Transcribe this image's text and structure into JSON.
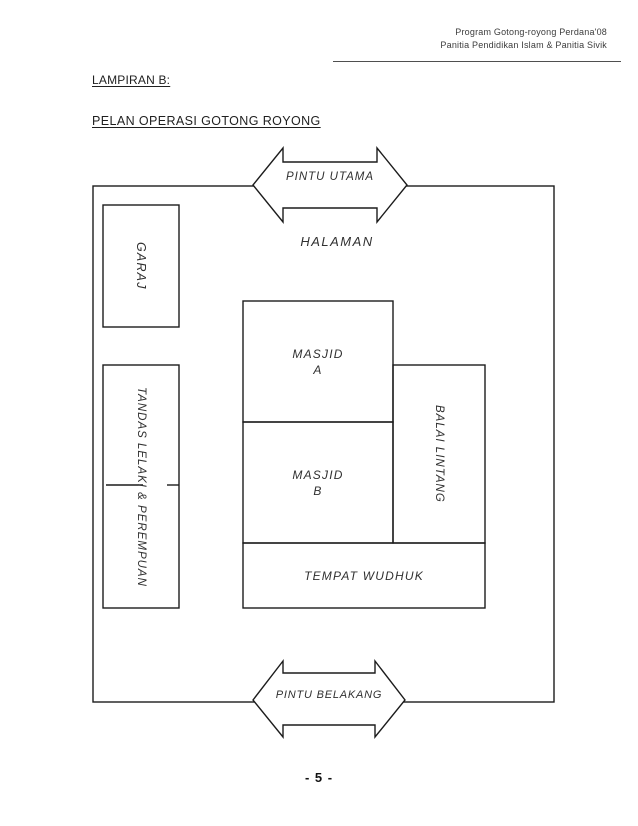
{
  "header": {
    "line1": "Program Gotong-royong Perdana'08",
    "line2": "Panitia Pendidikan Islam & Panitia Sivik"
  },
  "titles": {
    "lampiran": "LAMPIRAN B:",
    "main": "PELAN OPERASI GOTONG ROYONG"
  },
  "diagram": {
    "gates": {
      "top": "PINTU UTAMA",
      "bottom": "PINTU BELAKANG"
    },
    "areas": {
      "halaman": "HALAMAN",
      "garaj": "GARAJ",
      "tandas": "TANDAS LELAKI & PEREMPUAN",
      "masjid_a": {
        "line1": "MASJID",
        "line2": "A"
      },
      "masjid_b": {
        "line1": "MASJID",
        "line2": "B"
      },
      "balai": "BALAI LINTANG",
      "wudhuk": "TEMPAT WUDHUK"
    }
  },
  "footer": {
    "page_number": "- 5 -"
  },
  "colors": {
    "paper": "#ffffff",
    "line": "#1c1c1c",
    "text": "#303030"
  }
}
